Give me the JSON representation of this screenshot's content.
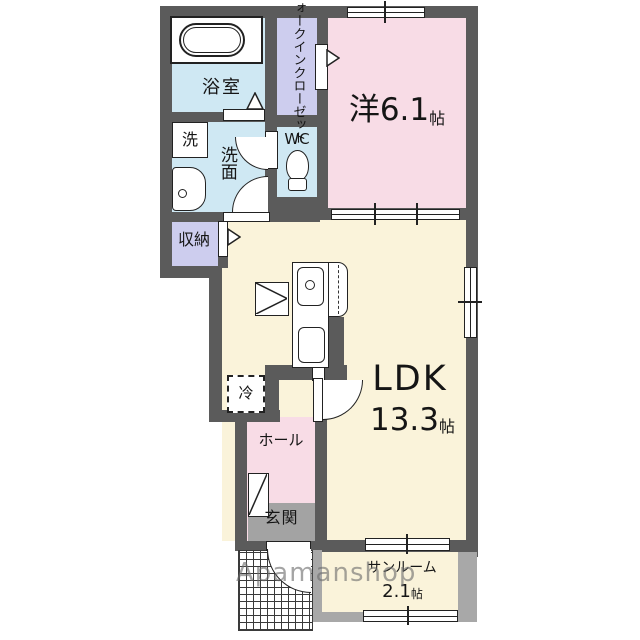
{
  "colors": {
    "wall": "#5b5b5b",
    "sunroom_wall": "#a8a8a8",
    "room_pink": "#f8dce6",
    "room_cream": "#faf3da",
    "room_blue": "#cfe8f3",
    "room_lavender": "#cdcdee",
    "entrance_gray": "#a3a3a3",
    "watermark_gray": "#6e6e6e"
  },
  "watermark": {
    "label": "Apamanshop"
  },
  "rooms": {
    "bathroom": {
      "label": "浴室"
    },
    "walk_in_closet": {
      "label": "ウォークインクローゼット"
    },
    "washer": {
      "label": "洗"
    },
    "washroom": {
      "label": "洗面"
    },
    "wc": {
      "label": "WC"
    },
    "western_room": {
      "label": "洋6.1",
      "unit": "帖"
    },
    "storage": {
      "label": "収納"
    },
    "refrigerator": {
      "label": "冷"
    },
    "ldk": {
      "label": "LDK",
      "area": "13.3",
      "unit": "帖"
    },
    "hall": {
      "label": "ホール"
    },
    "entrance": {
      "label": "玄関"
    },
    "sunroom": {
      "label": "サンルーム",
      "area": "2.1",
      "unit": "帖"
    }
  },
  "fixtures": [
    "bathtub-icon",
    "washing-machine-space-icon",
    "washbasin-icon",
    "toilet-icon",
    "kitchen-sink-icon",
    "stove-icon",
    "counter-icon",
    "dining-table-icon",
    "refrigerator-space-icon",
    "shoe-cabinet-icon",
    "door-swing-icon",
    "sliding-door-icon",
    "window-icon",
    "entry-arrow-icon",
    "folding-door-icon"
  ]
}
